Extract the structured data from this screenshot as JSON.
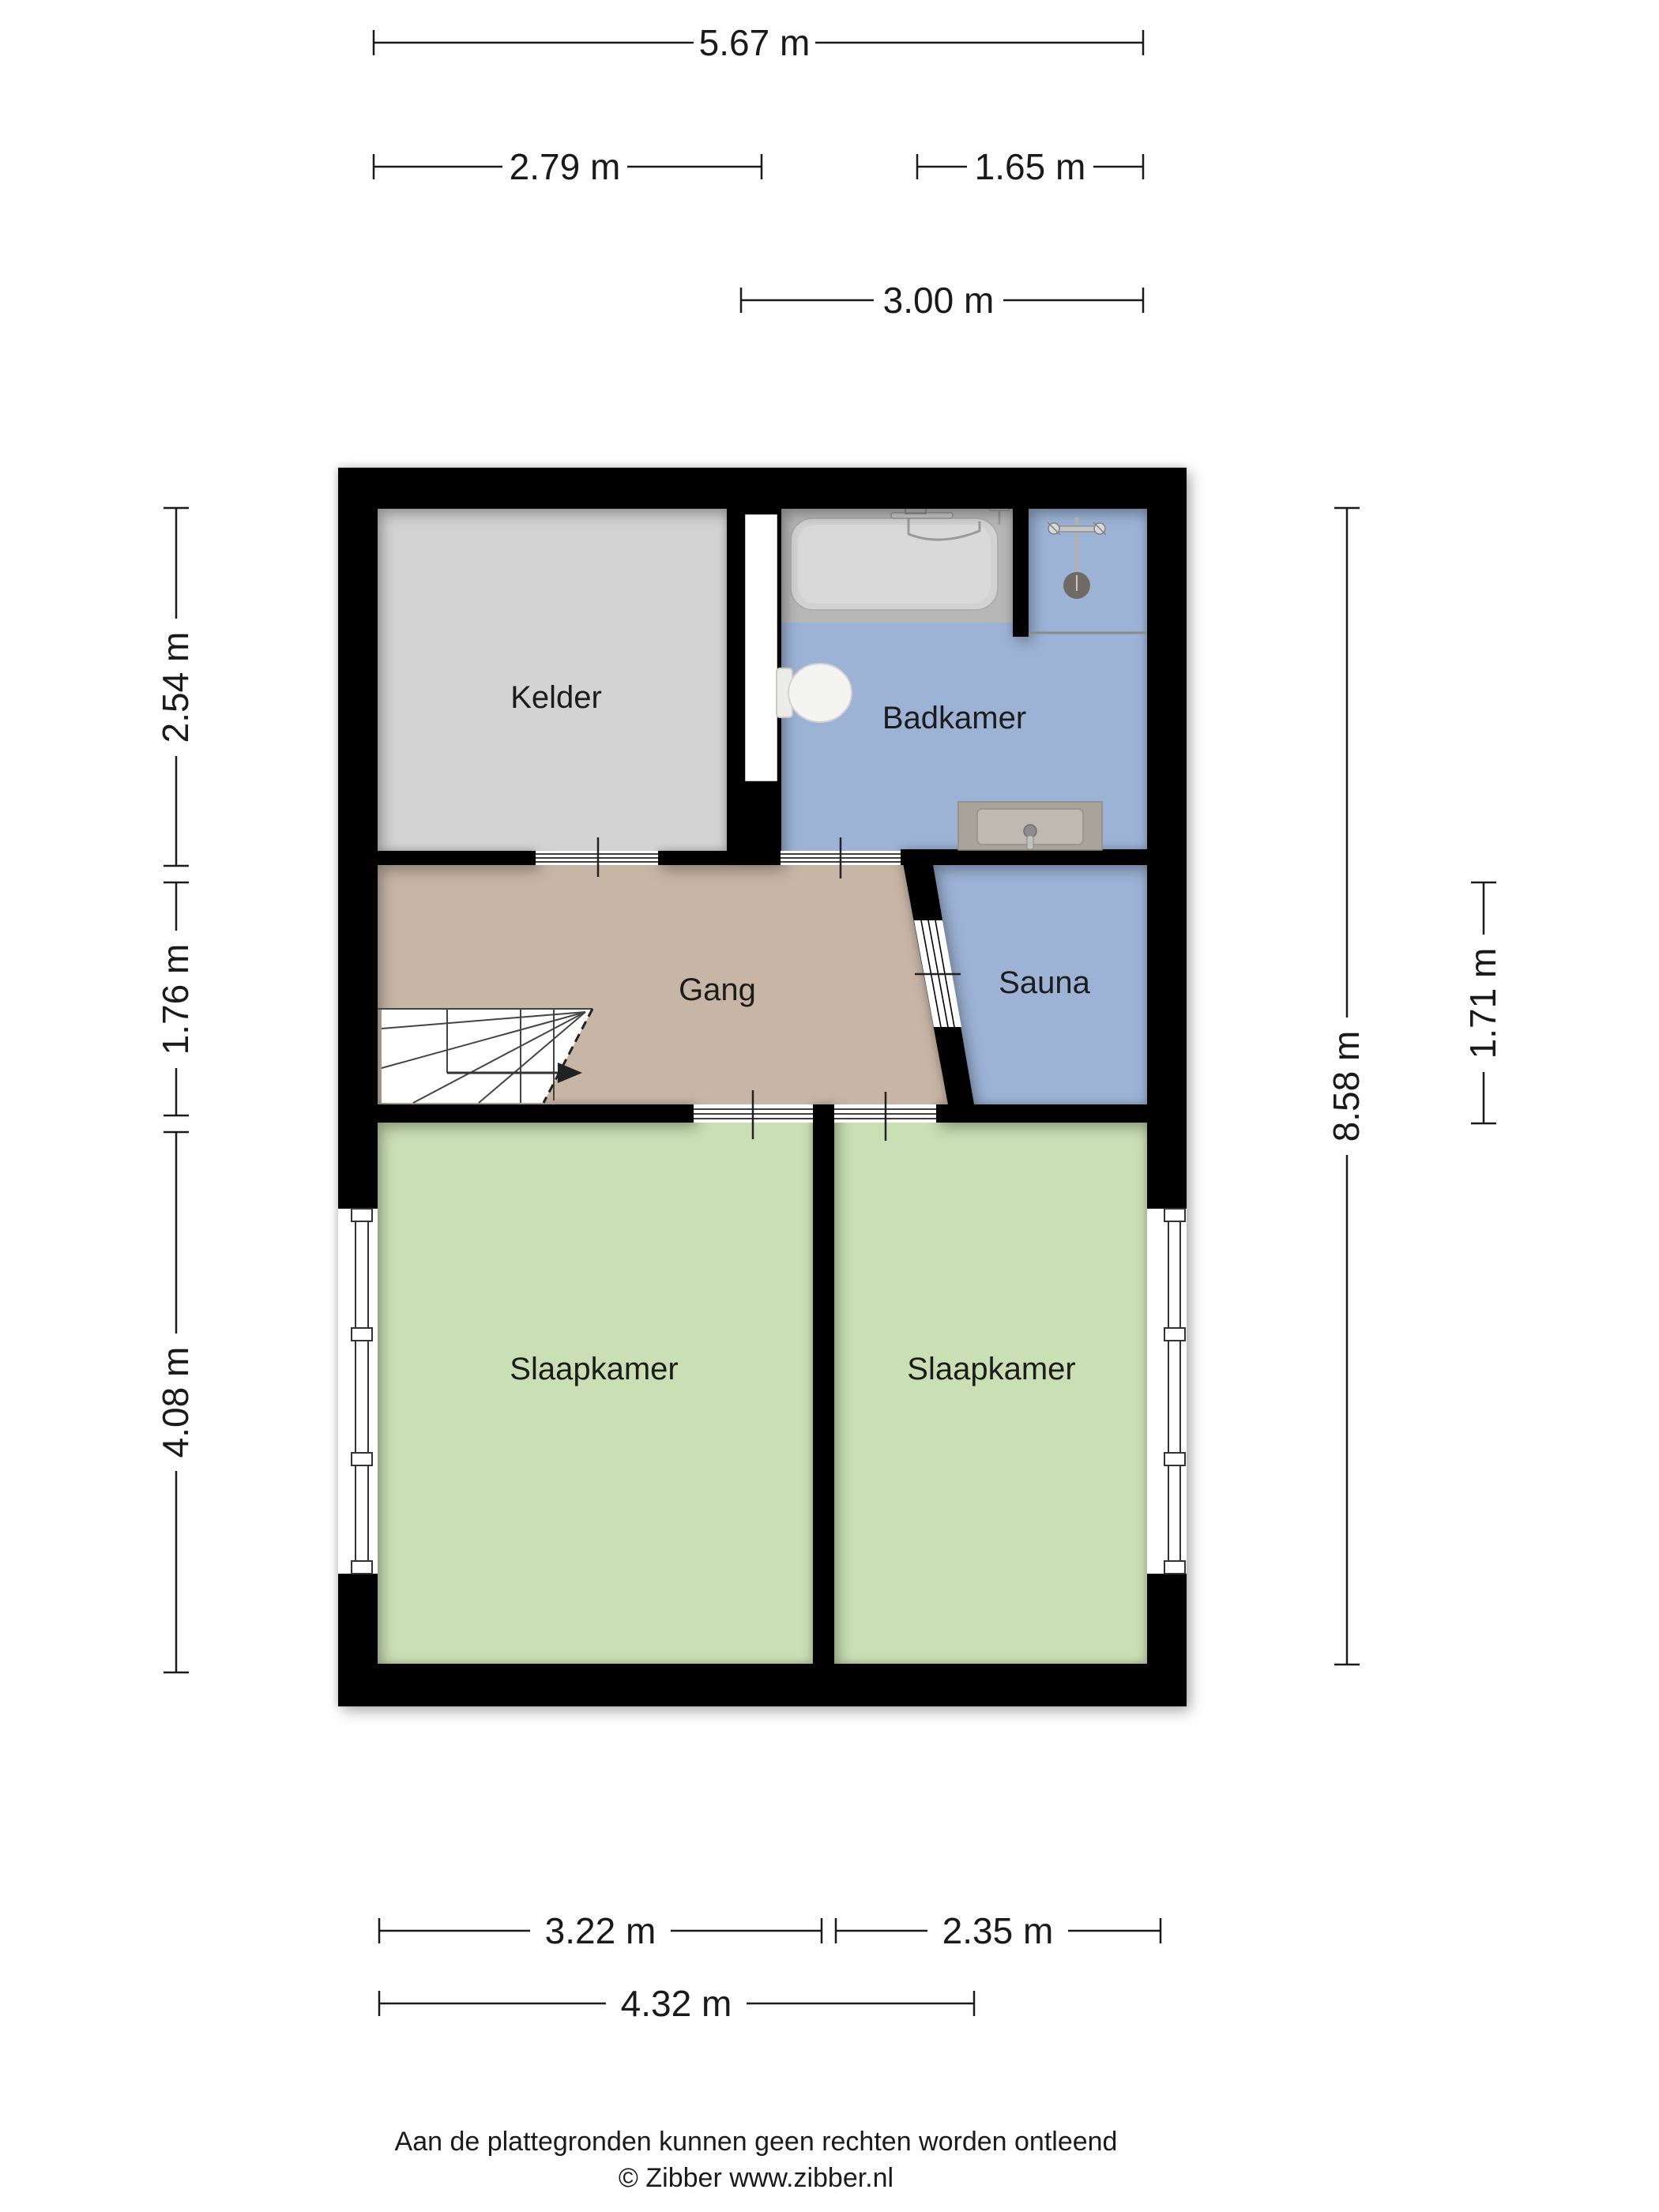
{
  "rooms": {
    "kelder": {
      "label": "Kelder"
    },
    "badkamer": {
      "label": "Badkamer"
    },
    "gang": {
      "label": "Gang"
    },
    "sauna": {
      "label": "Sauna"
    },
    "slaapkamer_links": {
      "label": "Slaapkamer"
    },
    "slaapkamer_rechts": {
      "label": "Slaapkamer"
    }
  },
  "dimensions": {
    "top_total": {
      "label": "5.67 m"
    },
    "top_left": {
      "label": "2.79 m"
    },
    "top_right": {
      "label": "1.65 m"
    },
    "top_bath": {
      "label": "3.00 m"
    },
    "left_kelder": {
      "label": "2.54 m"
    },
    "left_gang": {
      "label": "1.76 m"
    },
    "left_slaapkamer": {
      "label": "4.08 m"
    },
    "right_total": {
      "label": "8.58 m"
    },
    "right_sauna": {
      "label": "1.71 m"
    },
    "bottom_sl_links": {
      "label": "3.22 m"
    },
    "bottom_sl_rechts": {
      "label": "2.35 m"
    },
    "bottom_total": {
      "label": "4.32 m"
    }
  },
  "footer": {
    "line1": "Aan de plattegronden kunnen geen rechten worden ontleend",
    "line2": "© Zibber www.zibber.nl"
  },
  "colors": {
    "wall": "#000000",
    "kelder": "#d3d3d3",
    "badkamer": "#9db3d6",
    "sauna": "#9db3d6",
    "gang": "#c7b5a5",
    "slaapkamer": "#cadfb4",
    "tub_outer": "#b7b7b7",
    "tub_inner": "#d2d2d2",
    "vanity": "#a8a39b",
    "shower_head": "#6f6a63",
    "dimension_text": "#1a1a1a"
  },
  "icons": {
    "bathtub": "bathtub-icon",
    "shower": "shower-icon",
    "toilet": "toilet-icon",
    "sink": "sink-icon",
    "stairs": "stairs-icon",
    "window": "window-icon"
  }
}
